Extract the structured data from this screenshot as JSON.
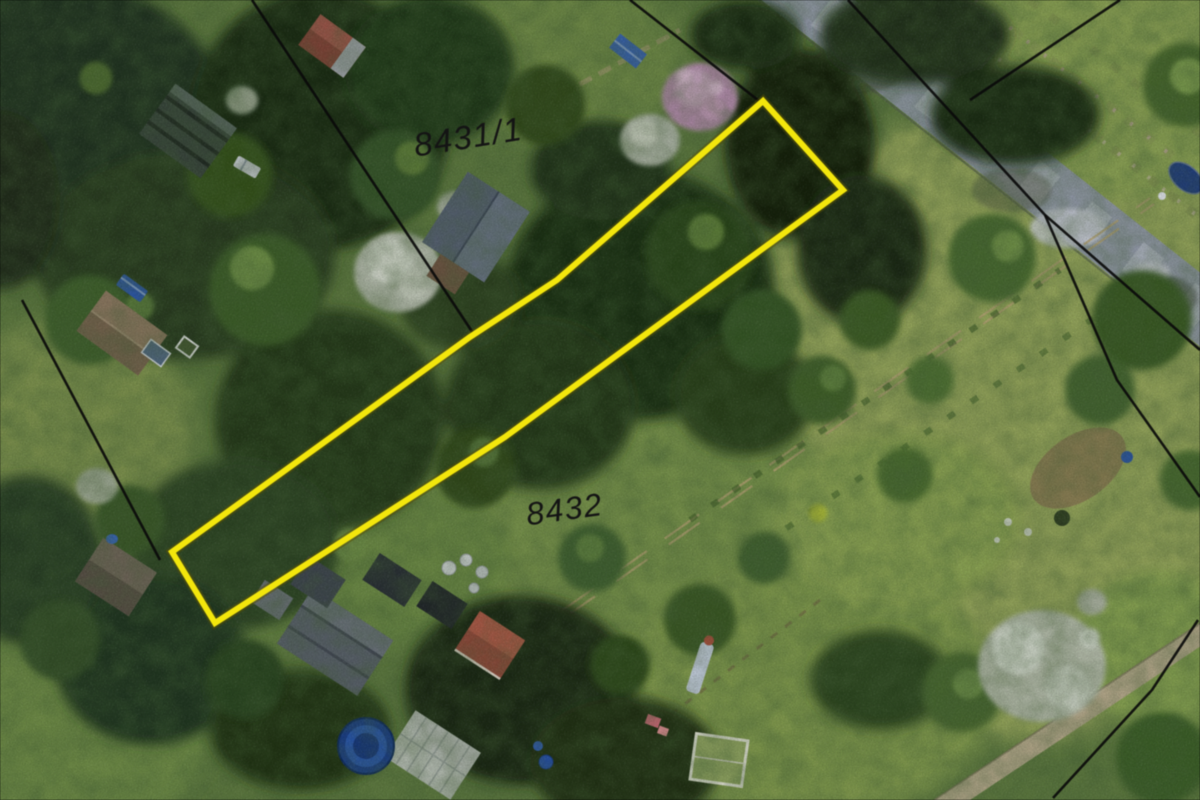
{
  "map": {
    "type": "aerial-cadastral-map",
    "parcel_labels": [
      {
        "text": "8431/1"
      },
      {
        "text": "8432"
      }
    ],
    "highlight": {
      "outline_d": "M763,101 L843,190 L505,437 L215,623 L172,552 L470,337 L557,280 Z"
    },
    "boundaries": {
      "b1": "M252,0 L475,336",
      "b2": "M630,0 L763,104",
      "b3": "M848,0 L1045,215 L1200,350",
      "b4": "M1045,215 L1117,380 L1200,497",
      "b5": "M1120,0 L970,100",
      "b6": "M22,300 L160,560",
      "b7": "M1198,620 L1152,690 L1053,798"
    },
    "colors": {
      "highlight": "#f1e513",
      "boundary": "#0b0b0b",
      "label": "#151515",
      "road": "#929aa7",
      "grass_base": "#5f7a42",
      "forest_dark": "#1e3218",
      "blossom_white": "#b4bbac",
      "blossom_pink": "#ab89a4",
      "trampoline_blue": "#1c3f85"
    }
  }
}
